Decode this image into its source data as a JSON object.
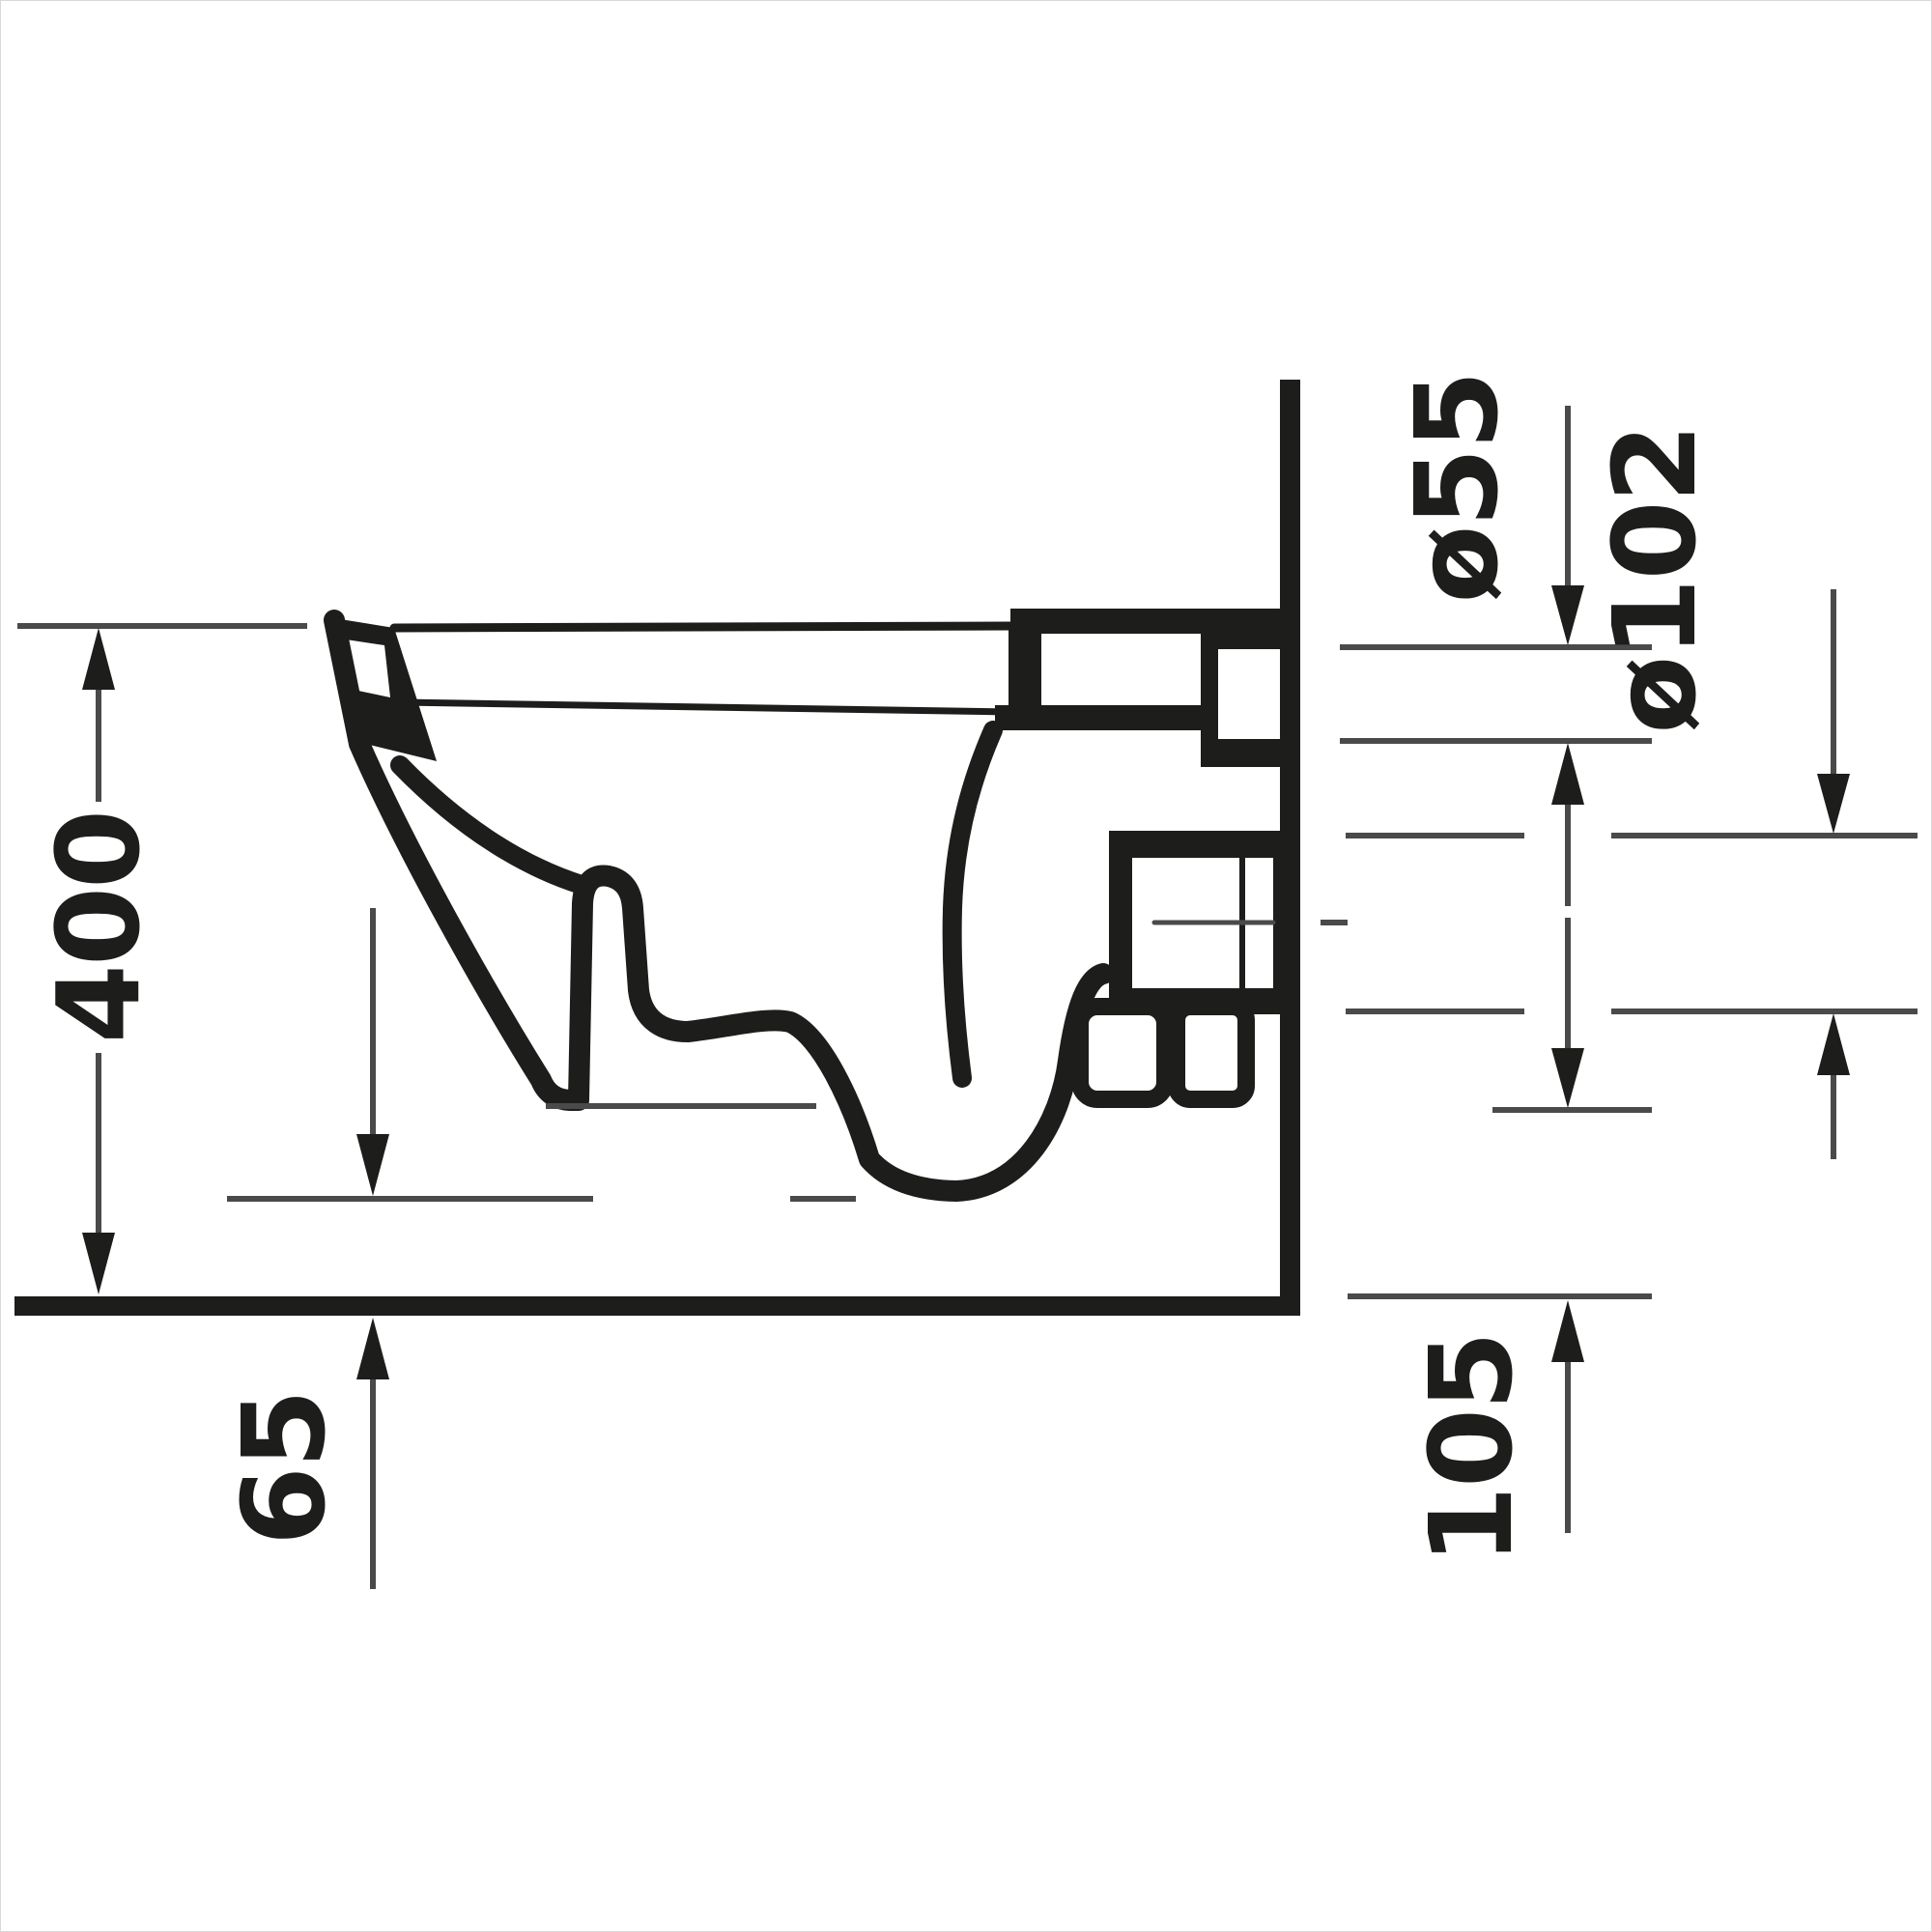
{
  "drawing": {
    "title": "wall-hung-toilet-side-section-technical-drawing",
    "units_note": "",
    "colors": {
      "outline": "#1d1d1b",
      "dimension_line": "#4a4a4a",
      "background": "#ffffff"
    },
    "dims": {
      "overall_height": {
        "label": "400",
        "orientation": "vertical",
        "side": "left"
      },
      "floor_clearance": {
        "label": "65",
        "orientation": "vertical",
        "side": "bottom-left"
      },
      "inlet_diameter": {
        "label": "ø55",
        "orientation": "vertical",
        "side": "top-right"
      },
      "outlet_diameter": {
        "label": "ø102",
        "orientation": "vertical",
        "side": "right"
      },
      "outlet_height": {
        "label": "105",
        "orientation": "vertical",
        "side": "bottom-right"
      }
    }
  }
}
